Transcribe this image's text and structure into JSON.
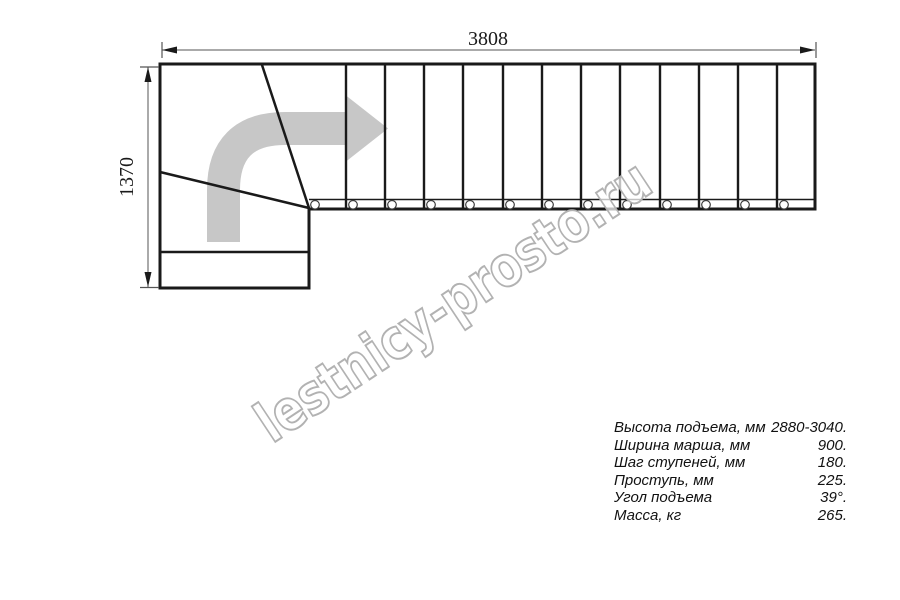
{
  "diagram": {
    "top_dimension": "3808",
    "left_dimension": "1370",
    "watermark": "lestnicy-prosto.ru",
    "colors": {
      "line": "#1a1a1a",
      "arrow": "#c7c7c7",
      "dimension": "#555555",
      "watermark_stroke": "#b2b2b2"
    }
  },
  "icons": {
    "direction_arrow": "curved-right-direction-arrow"
  },
  "specs": {
    "rows": [
      {
        "label": "Высота подъема, мм",
        "value": "2880-3040."
      },
      {
        "label": "Ширина марша, мм",
        "value": "900."
      },
      {
        "label": "Шаг ступеней, мм",
        "value": "180."
      },
      {
        "label": "Проступь, мм",
        "value": "225."
      },
      {
        "label": "Угол подъема",
        "value": "39°."
      },
      {
        "label": "Масса, кг",
        "value": "265."
      }
    ]
  }
}
